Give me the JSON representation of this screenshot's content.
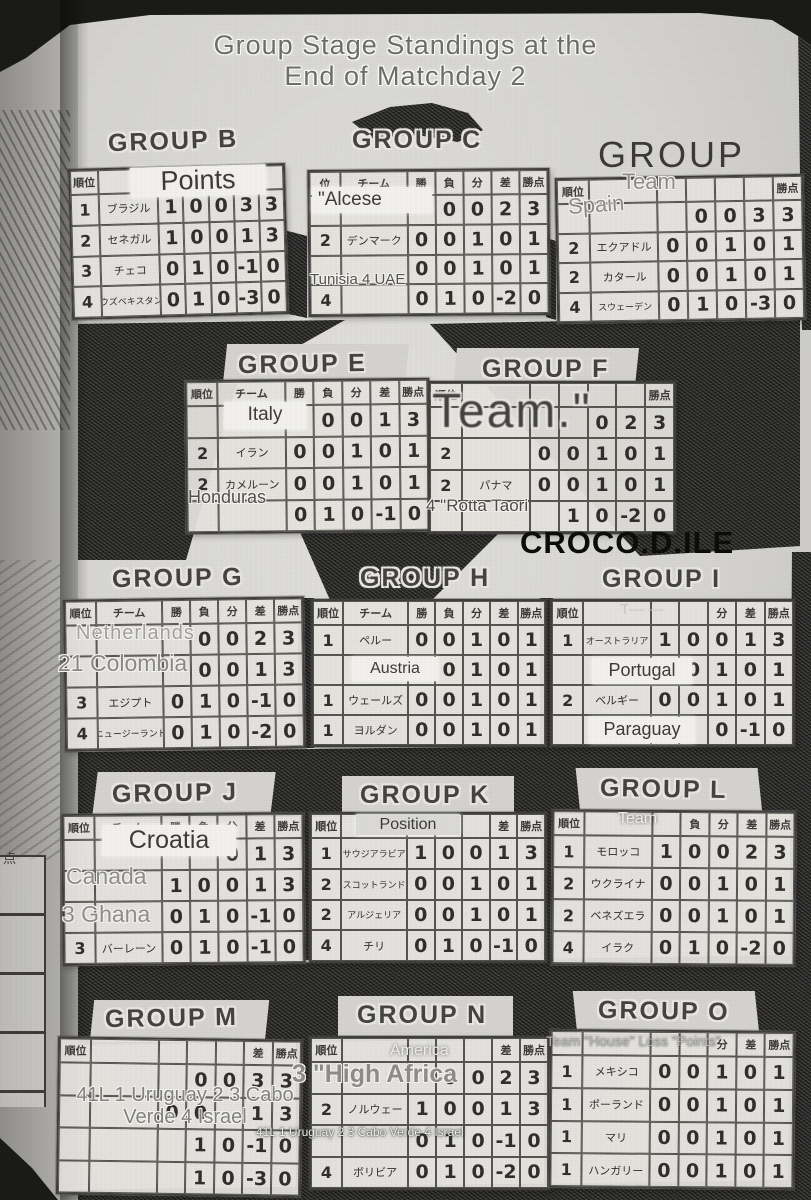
{
  "page": {
    "title_line1": "Group Stage Standings at the",
    "title_line2": "End of Matchday 2",
    "watermark": "CROCO.D.ILE",
    "adjacent_fragment": "点"
  },
  "groups": {
    "B": {
      "title": "GROUP B",
      "headers": [
        "順位",
        "",
        "",
        "",
        "",
        "",
        ""
      ],
      "rows": [
        [
          "1",
          "ブラジル",
          "1",
          "0",
          "0",
          "3",
          "3"
        ],
        [
          "2",
          "セネガル",
          "1",
          "0",
          "0",
          "1",
          "3"
        ],
        [
          "3",
          "チェコ",
          "0",
          "1",
          "0",
          "-1",
          "0"
        ],
        [
          "4",
          "ウズベキスタン",
          "0",
          "1",
          "0",
          "-3",
          "0"
        ]
      ],
      "overlays": {
        "header": "Points"
      }
    },
    "C": {
      "title": "GROUP C",
      "headers": [
        "位",
        "チーム",
        "勝",
        "負",
        "分",
        "差",
        "勝点"
      ],
      "rows": [
        [
          "",
          "",
          "",
          "0",
          "0",
          "2",
          "3"
        ],
        [
          "2",
          "デンマーク",
          "0",
          "0",
          "1",
          "0",
          "1"
        ],
        [
          "",
          "",
          "0",
          "0",
          "1",
          "0",
          "1"
        ],
        [
          "4",
          "",
          "0",
          "1",
          "0",
          "-2",
          "0"
        ]
      ],
      "overlays": {
        "team1": "\"Alcese",
        "rows34": "Tunisia 4 UAE"
      }
    },
    "D": {
      "title": "GROUP",
      "headers": [
        "順位",
        "",
        "",
        "",
        "",
        "",
        "勝点"
      ],
      "rows": [
        [
          "",
          "",
          "",
          "0",
          "0",
          "3",
          "3"
        ],
        [
          "2",
          "エクアドル",
          "0",
          "0",
          "1",
          "0",
          "1"
        ],
        [
          "2",
          "カタール",
          "0",
          "0",
          "1",
          "0",
          "1"
        ],
        [
          "4",
          "スウェーデン",
          "0",
          "1",
          "0",
          "-3",
          "0"
        ]
      ],
      "overlays": {
        "header": "Team",
        "team1": "Spain"
      }
    },
    "E": {
      "title": "GROUP E",
      "headers": [
        "順位",
        "チーム",
        "勝",
        "負",
        "分",
        "差",
        "勝点"
      ],
      "rows": [
        [
          "",
          "",
          "1",
          "0",
          "0",
          "1",
          "3"
        ],
        [
          "2",
          "イラン",
          "0",
          "0",
          "1",
          "0",
          "1"
        ],
        [
          "2",
          "カメルーン",
          "0",
          "0",
          "1",
          "0",
          "1"
        ],
        [
          "",
          "",
          "0",
          "1",
          "0",
          "-1",
          "0"
        ]
      ],
      "overlays": {
        "team1": "Italy",
        "team4": "Honduras"
      }
    },
    "F": {
      "title": "GROUP F",
      "headers": [
        "順位",
        "",
        "",
        "",
        "",
        "",
        "勝点"
      ],
      "rows": [
        [
          "",
          "",
          "",
          "",
          "0",
          "2",
          "3"
        ],
        [
          "2",
          "",
          "0",
          "0",
          "1",
          "0",
          "1"
        ],
        [
          "2",
          "パナマ",
          "0",
          "0",
          "1",
          "0",
          "1"
        ],
        [
          "",
          "",
          "",
          "1",
          "0",
          "-2",
          "0"
        ]
      ],
      "overlays": {
        "big": "Team.\"",
        "row4": "4 \"Rotta Taori"
      }
    },
    "G": {
      "title": "GROUP G",
      "headers": [
        "順位",
        "チーム",
        "勝",
        "負",
        "分",
        "差",
        "勝点"
      ],
      "rows": [
        [
          "",
          "",
          "",
          "0",
          "0",
          "2",
          "3"
        ],
        [
          "",
          "",
          "",
          "0",
          "0",
          "1",
          "3"
        ],
        [
          "3",
          "エジプト",
          "0",
          "1",
          "0",
          "-1",
          "0"
        ],
        [
          "4",
          "ニュージーランド",
          "0",
          "1",
          "0",
          "-2",
          "0"
        ]
      ],
      "overlays": {
        "row1": "Netherlands",
        "row2": "21 Colombia"
      }
    },
    "H": {
      "title": "GROUP H",
      "headers": [
        "順位",
        "チーム",
        "勝",
        "負",
        "分",
        "差",
        "勝点"
      ],
      "rows": [
        [
          "1",
          "ペルー",
          "0",
          "0",
          "1",
          "0",
          "1"
        ],
        [
          "",
          "",
          "",
          "0",
          "1",
          "0",
          "1"
        ],
        [
          "1",
          "ウェールズ",
          "0",
          "0",
          "1",
          "0",
          "1"
        ],
        [
          "1",
          "ヨルダン",
          "0",
          "0",
          "1",
          "0",
          "1"
        ]
      ],
      "overlays": {
        "team2": "Austria"
      }
    },
    "I": {
      "title": "GROUP I",
      "headers": [
        "順位",
        "",
        "",
        "",
        "分",
        "差",
        "勝点"
      ],
      "rows": [
        [
          "1",
          "オーストラリア",
          "1",
          "0",
          "0",
          "1",
          "3"
        ],
        [
          "",
          "",
          "",
          "0",
          "1",
          "0",
          "1"
        ],
        [
          "2",
          "ベルギー",
          "0",
          "0",
          "1",
          "0",
          "1"
        ],
        [
          "",
          "",
          "",
          "",
          "0",
          "-1",
          "0"
        ]
      ],
      "overlays": {
        "header": "T— —",
        "team2": "Portugal",
        "team4": "Paraguay"
      }
    },
    "J": {
      "title": "GROUP J",
      "headers": [
        "順位",
        "チーム",
        "勝",
        "負",
        "分",
        "差",
        "勝点"
      ],
      "rows": [
        [
          "",
          "",
          "",
          "",
          "0",
          "1",
          "3"
        ],
        [
          "",
          "",
          "1",
          "0",
          "0",
          "1",
          "3"
        ],
        [
          "",
          "",
          "0",
          "1",
          "0",
          "-1",
          "0"
        ],
        [
          "3",
          "バーレーン",
          "0",
          "1",
          "0",
          "-1",
          "0"
        ]
      ],
      "overlays": {
        "row1": "Croatia",
        "row2": "Canada",
        "row3": "3 Ghana"
      }
    },
    "K": {
      "title": "GROUP K",
      "headers": [
        "順位",
        "",
        "",
        "",
        "",
        "差",
        "勝点"
      ],
      "rows": [
        [
          "1",
          "サウジアラビア",
          "1",
          "0",
          "0",
          "1",
          "3"
        ],
        [
          "2",
          "スコットランド",
          "0",
          "0",
          "1",
          "0",
          "1"
        ],
        [
          "2",
          "アルジェリア",
          "0",
          "0",
          "1",
          "0",
          "1"
        ],
        [
          "4",
          "チリ",
          "0",
          "1",
          "0",
          "-1",
          "0"
        ]
      ],
      "overlays": {
        "header": "Position"
      }
    },
    "L": {
      "title": "GROUP L",
      "headers": [
        "順位",
        "",
        "",
        "負",
        "分",
        "差",
        "勝点"
      ],
      "rows": [
        [
          "1",
          "モロッコ",
          "1",
          "0",
          "0",
          "2",
          "3"
        ],
        [
          "2",
          "ウクライナ",
          "0",
          "0",
          "1",
          "0",
          "1"
        ],
        [
          "2",
          "ベネズエラ",
          "0",
          "0",
          "1",
          "0",
          "1"
        ],
        [
          "4",
          "イラク",
          "0",
          "1",
          "0",
          "-2",
          "0"
        ]
      ],
      "overlays": {
        "header": "Team"
      }
    },
    "M": {
      "title": "GROUP M",
      "headers": [
        "順位",
        "",
        "",
        "",
        "",
        "差",
        "勝点"
      ],
      "rows": [
        [
          "",
          "",
          "",
          "0",
          "0",
          "3",
          "3"
        ],
        [
          "",
          "",
          "0",
          "0",
          "",
          "1",
          "3"
        ],
        [
          "",
          "",
          "",
          "1",
          "0",
          "-1",
          "0"
        ],
        [
          "",
          "",
          "",
          "1",
          "0",
          "-3",
          "0"
        ]
      ],
      "overlays": {
        "note_big": "41L 1 Uruguay 2 3 Cabo\nVerde 4 Israel",
        "note_small": "41L 1 Uruguay 2 3 Cabo Verde 4 Israel"
      }
    },
    "N": {
      "title": "GROUP N",
      "headers": [
        "順位",
        "",
        "",
        "",
        "",
        "差",
        "勝点"
      ],
      "rows": [
        [
          "",
          "",
          "",
          "0",
          "0",
          "2",
          "3"
        ],
        [
          "2",
          "ノルウェー",
          "1",
          "0",
          "0",
          "1",
          "3"
        ],
        [
          "",
          "",
          "0",
          "1",
          "0",
          "-1",
          "0"
        ],
        [
          "4",
          "ボリビア",
          "0",
          "1",
          "0",
          "-2",
          "0"
        ]
      ],
      "overlays": {
        "header": "America",
        "row1": "3 \"High Africa"
      }
    },
    "O": {
      "title": "GROUP O",
      "headers": [
        "",
        "",
        "",
        "",
        "分",
        "差",
        "勝点"
      ],
      "rows": [
        [
          "1",
          "メキシコ",
          "0",
          "0",
          "1",
          "0",
          "1"
        ],
        [
          "1",
          "ポーランド",
          "0",
          "0",
          "1",
          "0",
          "1"
        ],
        [
          "1",
          "マリ",
          "0",
          "0",
          "1",
          "0",
          "1"
        ],
        [
          "1",
          "ハンガリー",
          "0",
          "0",
          "1",
          "0",
          "1"
        ]
      ],
      "overlays": {
        "header": "Team \"House\" Loss \"Points\""
      }
    }
  }
}
